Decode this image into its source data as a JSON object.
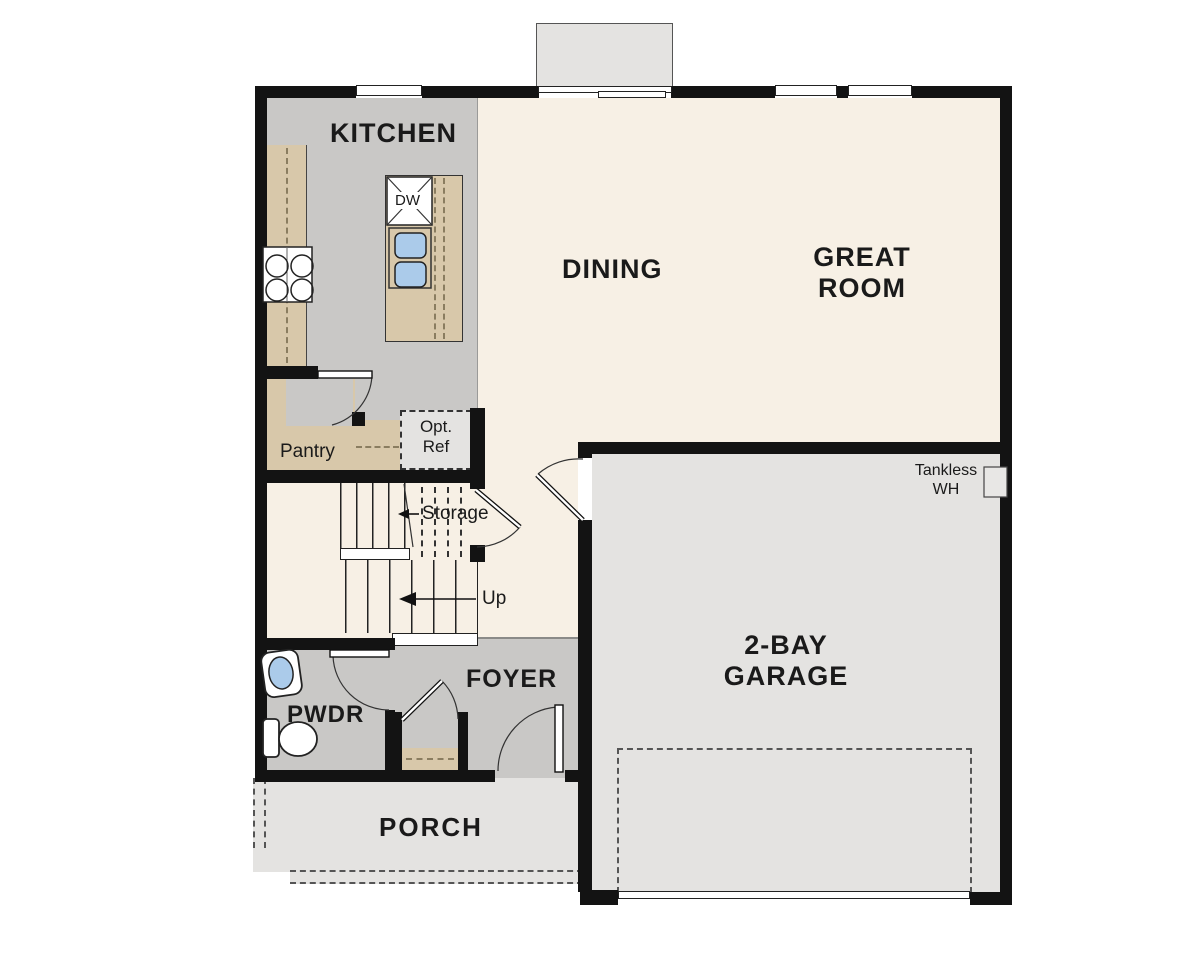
{
  "labels": {
    "kitchen": "KITCHEN",
    "dining": "DINING",
    "great_room_line1": "GREAT",
    "great_room_line2": "ROOM",
    "garage_line1": "2-BAY",
    "garage_line2": "GARAGE",
    "foyer": "FOYER",
    "pwdr": "PWDR",
    "porch": "PORCH",
    "pantry": "Pantry",
    "storage": "Storage",
    "up": "Up",
    "dw": "DW",
    "opt_ref_line1": "Opt.",
    "opt_ref_line2": "Ref",
    "tankless_line1": "Tankless",
    "tankless_line2": "WH"
  },
  "colors": {
    "wall": "#131313",
    "floor_gray": "#c9c8c6",
    "floor_cream": "#f7f0e5",
    "floor_light": "#e4e3e1",
    "counter_tan": "#d8c8aa",
    "sink_blue": "#abcbea"
  }
}
